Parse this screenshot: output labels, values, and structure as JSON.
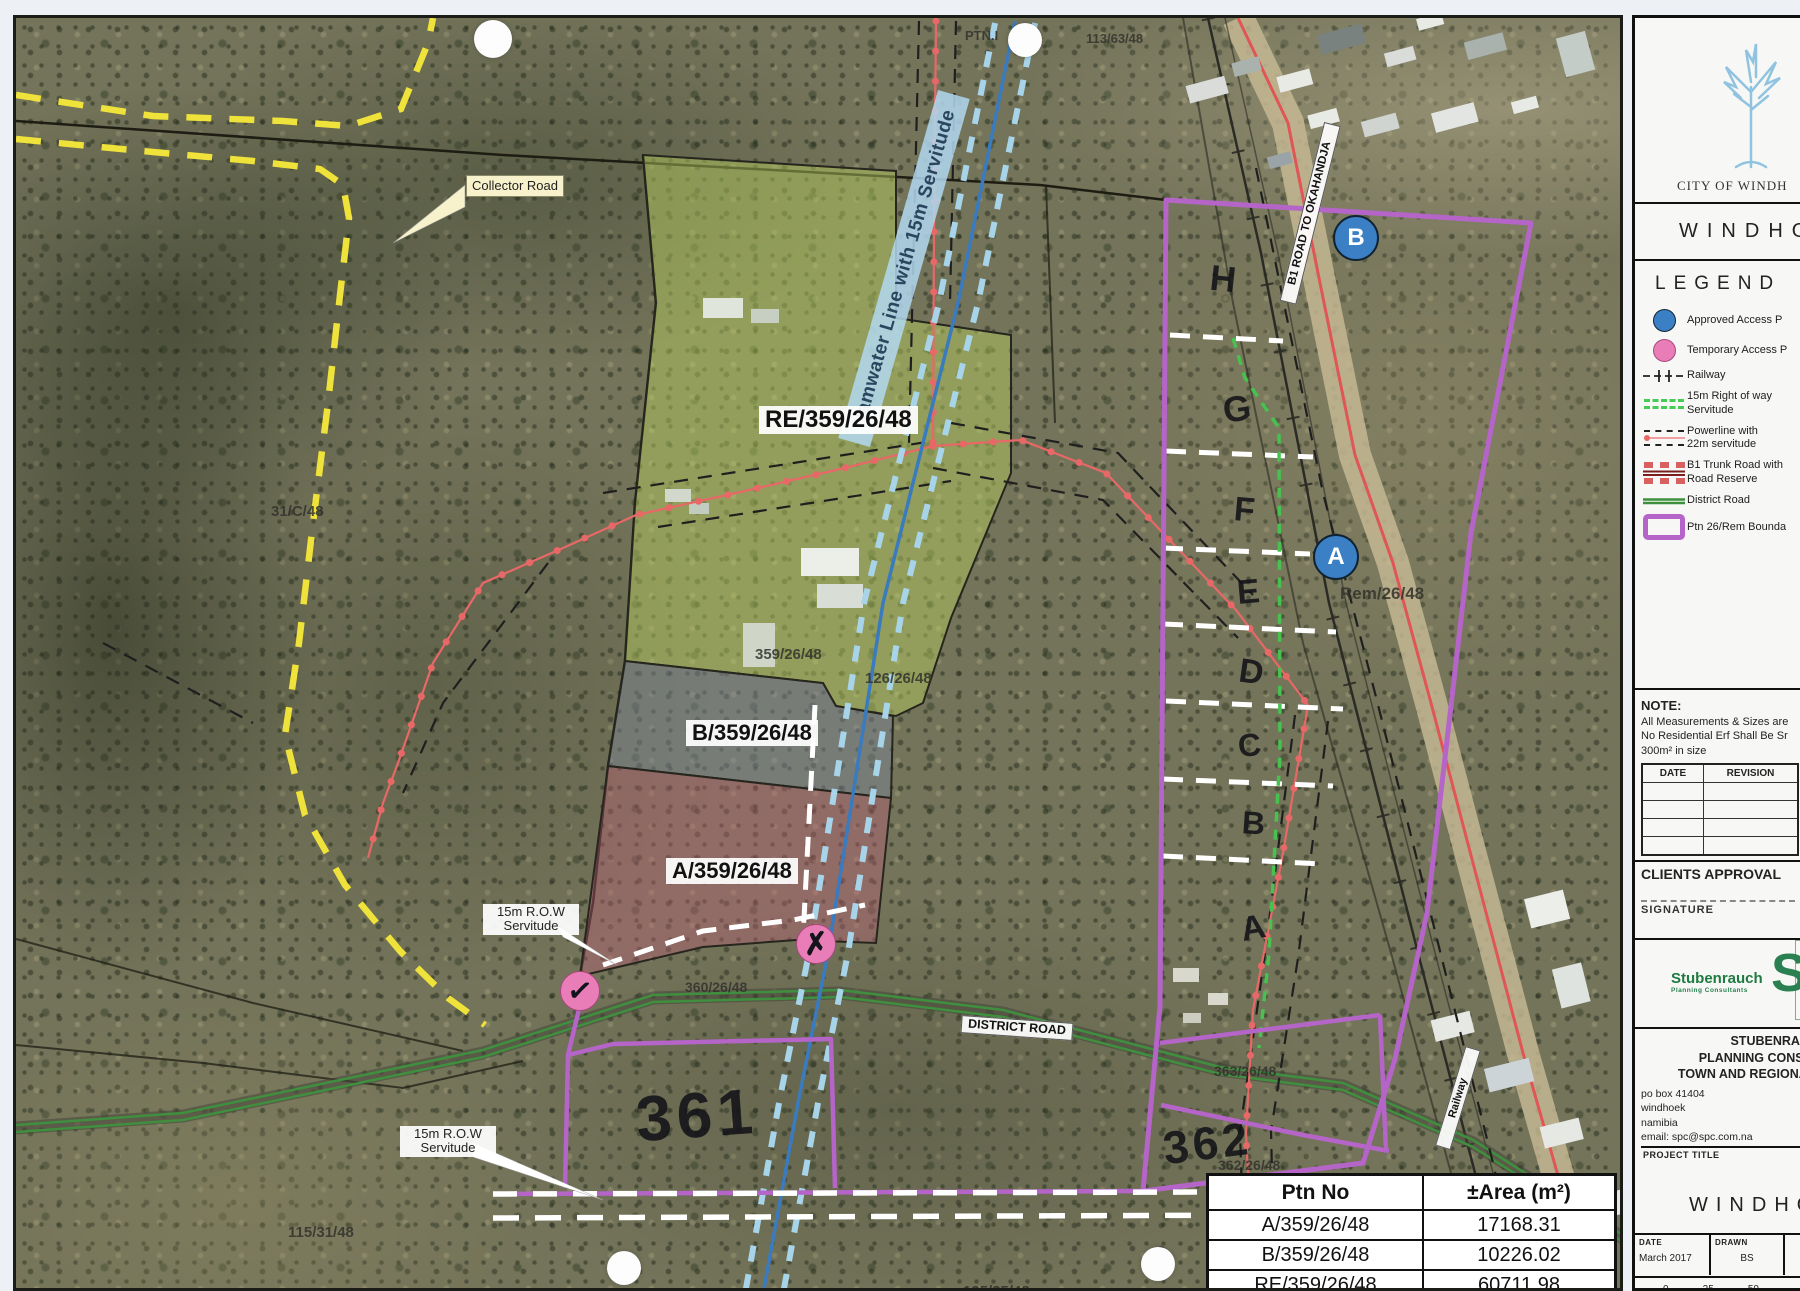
{
  "colors": {
    "boundary_purple": "#b565c8",
    "powerline_red": "#e86868",
    "namwater_blue": "#3a7bbf",
    "row_green": "#46c24f",
    "district_green": "#3f8f3f",
    "collector_yellow": "#efe23a",
    "access_blue": "#3b80c4",
    "access_pink": "#e87db8"
  },
  "map": {
    "labels": {
      "ptn": "PTN.I",
      "parcel_113": "113/63/48",
      "collector_road": "Collector Road",
      "namwater": "Namwater Line with 15m Servitude",
      "b1_road": "B1 ROAD TO OKAHANDJA",
      "re_parcel": "RE/359/26/48",
      "parcel_31c": "31/C/48",
      "parcel_359": "359/26/48",
      "b_parcel": "B/359/26/48",
      "parcel_126": "126/26/48",
      "a_parcel": "A/359/26/48",
      "rem_parcel": "Rem/26/48",
      "row_servitude_1": "15m R.O.W Servitude",
      "row_servitude_2": "15m R.O.W Servitude",
      "parcel_360": "360/26/48",
      "district_road": "DISTRICT ROAD",
      "railway": "Railway",
      "parcel_115": "115/31/48",
      "parcel_363": "363/26/48",
      "parcel_362": "362/26/48",
      "parcel_125": "125/25/48"
    },
    "handwriting": {
      "n361": "361",
      "n362": "362",
      "letters": [
        "H",
        "G",
        "F",
        "E",
        "D",
        "C",
        "B",
        "A"
      ]
    },
    "access_points": {
      "a": "A",
      "b": "B",
      "check": "✓",
      "cross": "✗"
    },
    "area_table": {
      "headers": [
        "Ptn No",
        "±Area (m²)"
      ],
      "rows": [
        {
          "ptn": "A/359/26/48",
          "area": "17168.31"
        },
        {
          "ptn": "B/359/26/48",
          "area": "10226.02"
        },
        {
          "ptn": "RE/359/26/48",
          "area": "60711.98"
        }
      ]
    }
  },
  "panel": {
    "city": "CITY OF WINDH",
    "municipality": "WINDHO",
    "legend": {
      "title": "LEGEND",
      "items": [
        {
          "label": "Approved Access P"
        },
        {
          "label": "Temporary Access P"
        },
        {
          "label": "Railway"
        },
        {
          "label": "15m Right of way",
          "label2": "Servitude"
        },
        {
          "label": "Powerline with",
          "label2": "22m servitude"
        },
        {
          "label": "B1 Trunk Road with",
          "label2": "Road Reserve"
        },
        {
          "label": "District Road"
        },
        {
          "label": "Ptn 26/Rem Bounda"
        }
      ]
    },
    "note": {
      "title": "NOTE:",
      "lines": [
        "All Measurements & Sizes are",
        "No Residential Erf Shall Be Sr",
        "300m² in size"
      ]
    },
    "revision_table": {
      "date": "DATE",
      "revision": "REVISION"
    },
    "clients_approval": "CLIENTS APPROVAL",
    "signature": "SIGNATURE",
    "logo": {
      "name": "Stubenrauch",
      "tagline": "Planning Consultants",
      "mark": "SP"
    },
    "firm": [
      "STUBENRAUCH",
      "PLANNING CONSULT",
      "TOWN AND REGIONAL P"
    ],
    "address": [
      "po box 41404",
      "windhoek",
      "namibia",
      "email: spc@spc.com.na"
    ],
    "contact": [
      "tel:",
      "tel:",
      "fax"
    ],
    "project_title_label": "PROJECT TITLE",
    "project_title": "WINDHOE",
    "meta": {
      "date_label": "DATE",
      "date": "March 2017",
      "drawn_label": "DRAWN",
      "drawn": "BS"
    },
    "scale": {
      "ticks": [
        "0",
        "25",
        "50"
      ],
      "unit": "Meters",
      "ratio": "1:5 000"
    }
  }
}
